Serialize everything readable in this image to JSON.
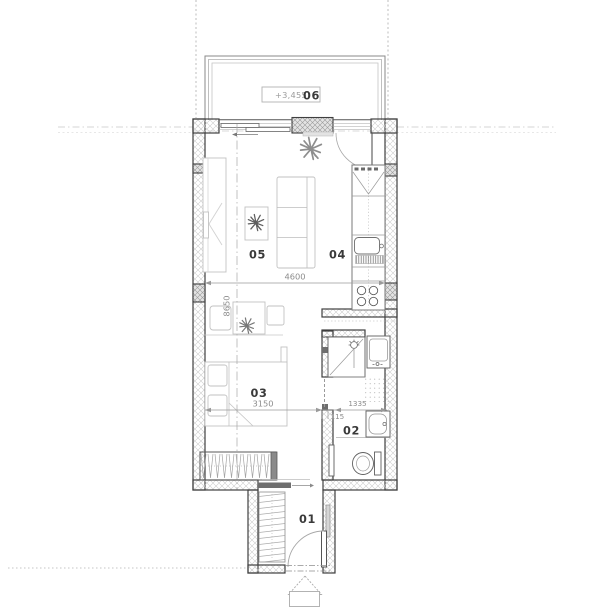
{
  "drawing_type": "apartment floor plan",
  "rooms": [
    {
      "number": "01",
      "name": "entry"
    },
    {
      "number": "02",
      "name": "bathroom"
    },
    {
      "number": "03",
      "name": "bedroom"
    },
    {
      "number": "04",
      "name": "kitchen"
    },
    {
      "number": "05",
      "name": "living-room"
    },
    {
      "number": "06",
      "name": "balcony"
    }
  ],
  "dimensions": {
    "living_width": "4600",
    "apartment_depth": "8650",
    "bedroom_width": "3150",
    "bathroom_width": "1335",
    "partition_thickness": "115"
  },
  "elevation": {
    "balcony": "+3,455"
  },
  "symbols": [
    "bed",
    "sofa",
    "coffee-table",
    "tv-unit",
    "desk",
    "chair",
    "wardrobe",
    "plant",
    "fridge",
    "kitchen-sink",
    "cooktop",
    "shower",
    "washing-machine",
    "washbasin",
    "toilet",
    "door-swing",
    "sliding-door",
    "entry-marker",
    "dimension-line",
    "railing"
  ],
  "colors": {
    "wall_outline": "#3f3f3f",
    "wall_hatch": "#cdcdcd",
    "furniture": "#c2c2c2",
    "fixture": "#5f5f5f",
    "dimension_text": "#8c8c8c",
    "label_text": "#3a3a3a",
    "guide": "#b8b8b8"
  }
}
